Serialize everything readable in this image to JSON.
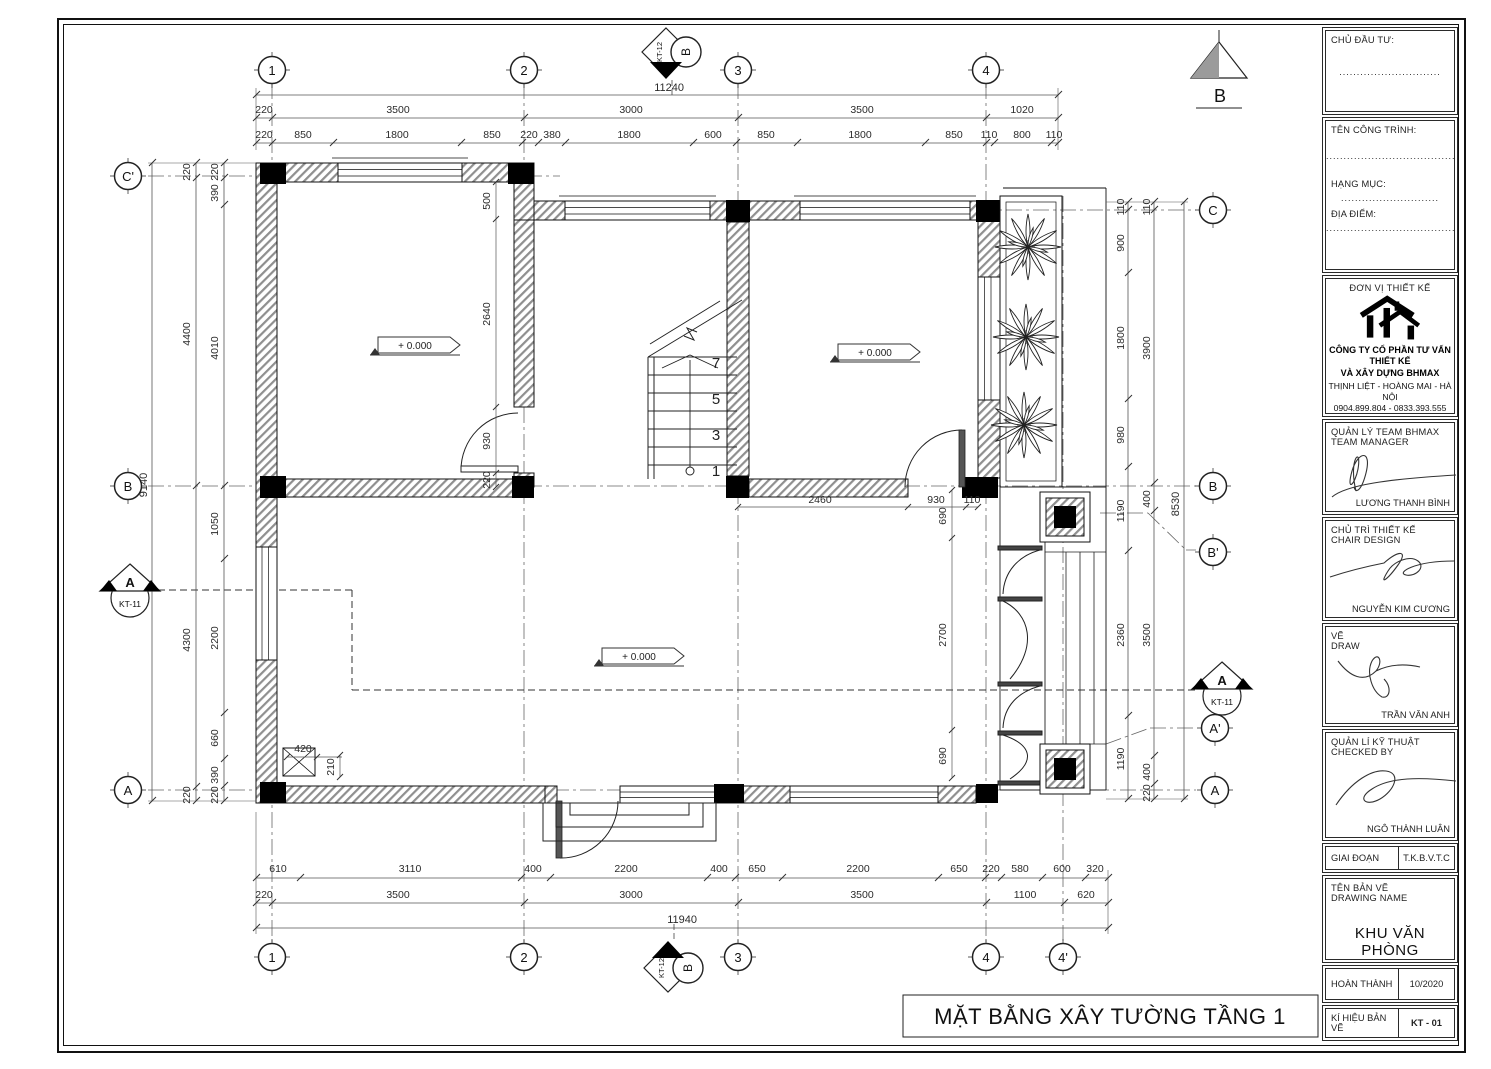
{
  "sheet": {
    "title": "MẶT BẰNG XÂY TƯỜNG TẦNG 1"
  },
  "grid": {
    "top": [
      "1",
      "2",
      "3",
      "4"
    ],
    "bottom": [
      "1",
      "2",
      "3",
      "4",
      "4'"
    ],
    "left": [
      "C'",
      "B",
      "A"
    ],
    "right": [
      "C",
      "B",
      "B'",
      "A'",
      "A"
    ]
  },
  "markers": {
    "kt11": "KT-11",
    "kt12": "KT-12",
    "a": "A",
    "b": "B",
    "dir_b": "B"
  },
  "levels": {
    "zero": "+ 0.000"
  },
  "stair": {
    "n1": "1",
    "n3": "3",
    "n5": "5",
    "n7": "7"
  },
  "dims": {
    "top_overall": "11240",
    "top1": [
      "220",
      "3500",
      "3000",
      "3500",
      "1020"
    ],
    "top2": [
      "220",
      "850",
      "1800",
      "850",
      "220",
      "380",
      "1800",
      "600",
      "850",
      "1800",
      "850",
      "110",
      "800",
      "110"
    ],
    "bottom1": [
      "610",
      "3110",
      "400",
      "2200",
      "400",
      "650",
      "2200",
      "650",
      "220",
      "580",
      "600",
      "320"
    ],
    "bottom2": [
      "220",
      "3500",
      "3000",
      "3500",
      "1100",
      "620"
    ],
    "bottom_overall": "11940",
    "left_overall": "9140",
    "left1": [
      "220",
      "4400",
      "4300",
      "220"
    ],
    "left2": [
      "220",
      "390",
      "4010",
      "1050",
      "2200",
      "660",
      "390",
      "220"
    ],
    "right1": [
      "110",
      "900",
      "1800",
      "980",
      "1190",
      "2360",
      "1190"
    ],
    "right2": [
      "110",
      "3900",
      "400",
      "3500",
      "400",
      "220"
    ],
    "right_overall": "8530",
    "interior": {
      "i500": "500",
      "i2640": "2640",
      "i930a": "930",
      "i220a": "220",
      "i2460": "2460",
      "i930b": "930",
      "i110": "110",
      "i690a": "690",
      "i2700": "2700",
      "i690b": "690",
      "i420": "420",
      "i210": "210"
    }
  },
  "titleblock": {
    "investor_label": "CHỦ ĐẦU TƯ:",
    "investor_dots": ".............................",
    "project_label": "TÊN CÔNG TRÌNH:",
    "project_dots": "......................................",
    "category_label": "HẠNG MỤC:",
    "category_dots": "............................",
    "location_label": "ĐỊA ĐIỂM:",
    "location_dots": "..........................................",
    "designer_label": "ĐƠN VỊ THIẾT KẾ",
    "company_line1": "CÔNG TY CỔ PHẦN TƯ VẤN THIẾT KẾ",
    "company_line2": "VÀ XÂY DỰNG BHMAX",
    "address": "THỊNH LIỆT - HOÀNG MAI - HÀ NỘI",
    "phone": "0904.899.804 - 0833.393.555",
    "roles": [
      {
        "l1": "QUẢN LÝ TEAM BHMAX",
        "l2": "TEAM MANAGER",
        "name": "LƯƠNG THANH BÌNH"
      },
      {
        "l1": "CHỦ TRÌ THIẾT KẾ",
        "l2": "CHAIR DESIGN",
        "name": "NGUYỄN KIM CƯƠNG"
      },
      {
        "l1": "VẼ",
        "l2": "DRAW",
        "name": "TRẦN VĂN ANH"
      },
      {
        "l1": "QUẢN LÍ KỸ THUẬT",
        "l2": "CHECKED BY",
        "name": "NGÔ THÀNH LUÂN"
      }
    ],
    "stage_label": "GIAI ĐOẠN",
    "stage_value": "T.K.B.V.T.C",
    "drawing_label1": "TÊN BẢN VẼ",
    "drawing_label2": "DRAWING NAME",
    "drawing_name": "KHU VĂN PHÒNG",
    "complete_label": "HOÀN THÀNH",
    "complete_value": "10/2020",
    "code_label": "KÍ HIỆU BẢN VẼ",
    "code_value": "KT - 01"
  }
}
